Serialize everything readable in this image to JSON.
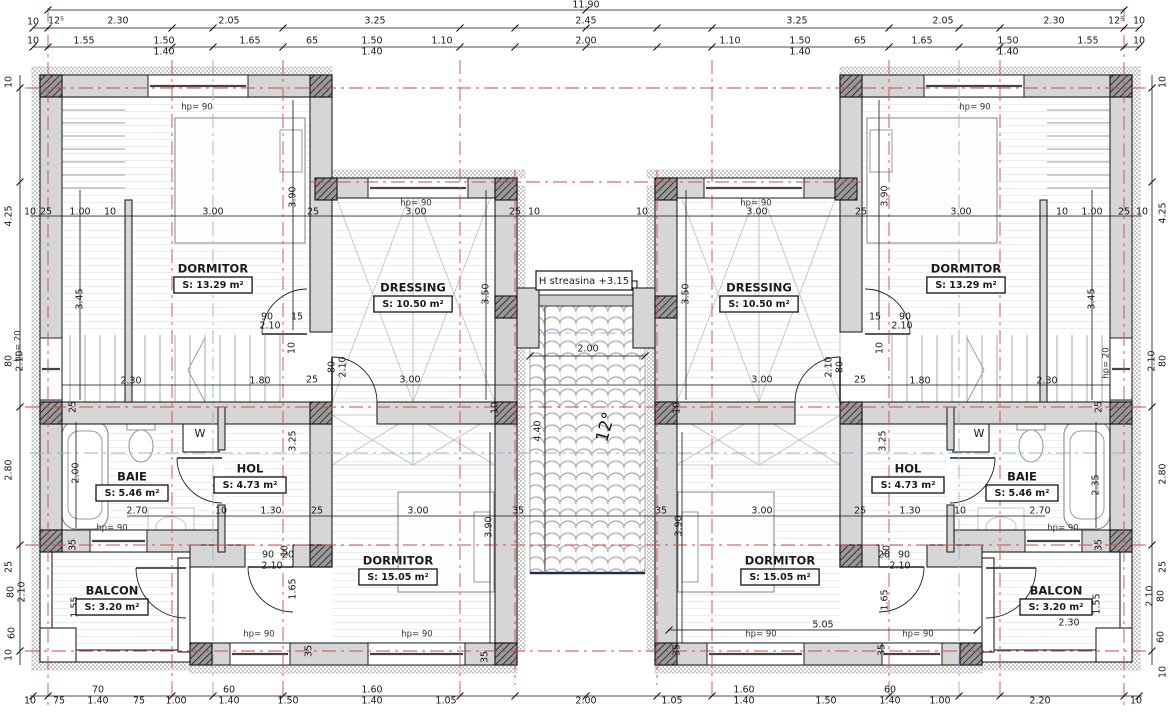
{
  "drawing": {
    "type": "floor-plan",
    "overall_width": "11.90",
    "eaves_note": "H streasina +3.15",
    "roof_slope": "12°",
    "colors": {
      "axis_red": "#cf4a4a",
      "axis_blue": "#8fb3dc",
      "wall_gray": "#d6d6d6",
      "pier_gray": "#9a9a9a",
      "line": "#222222",
      "fixture": "#9a9a9a",
      "tile": "#9a9a9a",
      "ridge_dark": "#223044"
    }
  },
  "rooms": [
    {
      "name": "DORMITOR",
      "area": "S: 13.29 m²",
      "x": 213,
      "y": 269
    },
    {
      "name": "DRESSING",
      "area": "S: 10.50 m²",
      "x": 413,
      "y": 288
    },
    {
      "name": "BAIE",
      "area": "S: 5.46 m²",
      "x": 132,
      "y": 477
    },
    {
      "name": "HOL",
      "area": "S: 4.73 m²",
      "x": 250,
      "y": 469
    },
    {
      "name": "DORMITOR",
      "area": "S: 15.05 m²",
      "x": 398,
      "y": 561
    },
    {
      "name": "BALCON",
      "area": "S: 3.20 m²",
      "x": 112,
      "y": 591
    },
    {
      "name": "DRESSING",
      "area": "S: 10.50 m²",
      "x": 759,
      "y": 288
    },
    {
      "name": "DORMITOR",
      "area": "S: 13.29 m²",
      "x": 966,
      "y": 269
    },
    {
      "name": "HOL",
      "area": "S: 4.73 m²",
      "x": 908,
      "y": 469
    },
    {
      "name": "BAIE",
      "area": "S: 5.46 m²",
      "x": 1022,
      "y": 477
    },
    {
      "name": "DORMITOR",
      "area": "S: 15.05 m²",
      "x": 780,
      "y": 561
    },
    {
      "name": "BALCON",
      "area": "S: 3.20 m²",
      "x": 1056,
      "y": 591
    }
  ],
  "dims": [
    [
      "11.90",
      586,
      5
    ],
    [
      "10",
      33,
      22
    ],
    [
      "12⁵",
      56,
      21
    ],
    [
      "2.30",
      118,
      21
    ],
    [
      "2.05",
      229,
      21
    ],
    [
      "3.25",
      375,
      21
    ],
    [
      "2.45",
      586,
      21
    ],
    [
      "3.25",
      797,
      21
    ],
    [
      "2.05",
      943,
      21
    ],
    [
      "2.30",
      1054,
      21
    ],
    [
      "12⁵",
      1116,
      21
    ],
    [
      "10",
      1139,
      21
    ],
    [
      "10",
      33,
      41
    ],
    [
      "1.55",
      84,
      41
    ],
    [
      "1.50",
      164,
      41
    ],
    [
      "1.65",
      250,
      41
    ],
    [
      "65",
      312,
      41
    ],
    [
      "1.50",
      372,
      41
    ],
    [
      "1.10",
      442,
      41
    ],
    [
      "2.00",
      586,
      41
    ],
    [
      "1.10",
      730,
      41
    ],
    [
      "1.50",
      800,
      41
    ],
    [
      "65",
      860,
      41
    ],
    [
      "1.65",
      922,
      41
    ],
    [
      "1.50",
      1008,
      41
    ],
    [
      "1.55",
      1088,
      41
    ],
    [
      "10",
      1139,
      41
    ],
    [
      "1.40",
      164,
      52
    ],
    [
      "1.40",
      372,
      52
    ],
    [
      "1.40",
      800,
      52
    ],
    [
      "1.40",
      1008,
      52
    ],
    [
      "10",
      30,
      212
    ],
    [
      "25",
      46,
      212
    ],
    [
      "1.00",
      80,
      212
    ],
    [
      "10",
      110,
      212
    ],
    [
      "3.00",
      213,
      212
    ],
    [
      "25",
      313,
      212
    ],
    [
      "3.00",
      416,
      212
    ],
    [
      "25",
      515,
      212
    ],
    [
      "10",
      534,
      212
    ],
    [
      "10",
      642,
      212
    ],
    [
      "3.00",
      757,
      212
    ],
    [
      "25",
      861,
      212
    ],
    [
      "3.00",
      961,
      212
    ],
    [
      "10",
      1062,
      212
    ],
    [
      "1.00",
      1092,
      212
    ],
    [
      "25",
      1124,
      212
    ],
    [
      "10",
      1142,
      212
    ],
    [
      "2.30",
      131,
      381
    ],
    [
      "1.80",
      260,
      381
    ],
    [
      "25",
      312,
      380
    ],
    [
      "3.00",
      410,
      380
    ],
    [
      "3.00",
      762,
      380
    ],
    [
      "25",
      860,
      380
    ],
    [
      "1.80",
      920,
      381
    ],
    [
      "2.30",
      1047,
      381
    ],
    [
      "2.70",
      137,
      511
    ],
    [
      "10",
      221,
      511
    ],
    [
      "1.30",
      271,
      511
    ],
    [
      "25",
      317,
      511
    ],
    [
      "3.00",
      418,
      511
    ],
    [
      "35",
      518,
      511
    ],
    [
      "35",
      661,
      511
    ],
    [
      "3.00",
      762,
      511
    ],
    [
      "25",
      860,
      511
    ],
    [
      "1.30",
      910,
      511
    ],
    [
      "10",
      960,
      511
    ],
    [
      "2.70",
      1040,
      511
    ],
    [
      "70",
      98,
      690
    ],
    [
      "60",
      229,
      690
    ],
    [
      "1.60",
      372,
      690
    ],
    [
      "1.60",
      744,
      690
    ],
    [
      "60",
      890,
      690
    ],
    [
      "10",
      30,
      701
    ],
    [
      "75",
      59,
      701
    ],
    [
      "1.40",
      98,
      701
    ],
    [
      "75",
      139,
      701
    ],
    [
      "1.00",
      176,
      701
    ],
    [
      "1.40",
      229,
      701
    ],
    [
      "1.50",
      288,
      701
    ],
    [
      "1.40",
      372,
      701
    ],
    [
      "1.05",
      446,
      701
    ],
    [
      "2.00",
      586,
      701
    ],
    [
      "1.05",
      672,
      701
    ],
    [
      "1.40",
      744,
      701
    ],
    [
      "1.50",
      826,
      701
    ],
    [
      "1.40",
      890,
      701
    ],
    [
      "1.00",
      940,
      701
    ],
    [
      "2.20",
      1040,
      701
    ],
    [
      "10",
      1136,
      701
    ],
    [
      "10",
      9,
      82,
      -90
    ],
    [
      "4.25",
      9,
      216,
      -90
    ],
    [
      "80",
      9,
      361,
      -90
    ],
    [
      "2.10",
      20,
      361,
      -90
    ],
    [
      "2.80",
      9,
      470,
      -90
    ],
    [
      "25",
      9,
      567,
      -90
    ],
    [
      "80",
      11,
      592,
      -90
    ],
    [
      "2.10",
      22,
      592,
      -90
    ],
    [
      "60",
      12,
      633,
      -90
    ],
    [
      "10",
      9,
      655,
      -90
    ],
    [
      "10",
      1163,
      82,
      -90
    ],
    [
      "4.25",
      1163,
      213,
      -90
    ],
    [
      "80",
      1163,
      361,
      -90
    ],
    [
      "2.10",
      1152,
      361,
      -90
    ],
    [
      "2.80",
      1163,
      474,
      -90
    ],
    [
      "25",
      1163,
      567,
      -90
    ],
    [
      "80",
      1161,
      596,
      -90
    ],
    [
      "2.10",
      1150,
      596,
      -90
    ],
    [
      "60",
      1161,
      637,
      -90
    ],
    [
      "10",
      1163,
      672,
      -90
    ],
    [
      "3.90",
      293,
      197,
      -90
    ],
    [
      "3.90",
      885,
      196,
      -90
    ],
    [
      "3.45",
      80,
      299,
      -90
    ],
    [
      "3.45",
      1092,
      299,
      -90
    ],
    [
      "3.50",
      486,
      294,
      -90
    ],
    [
      "3.50",
      686,
      294,
      -90
    ],
    [
      "25",
      73,
      407,
      -90
    ],
    [
      "25",
      1099,
      407,
      -90
    ],
    [
      "3.25",
      293,
      441,
      -90
    ],
    [
      "3.25",
      883,
      441,
      -90
    ],
    [
      "2.00",
      76,
      473,
      -90
    ],
    [
      "2.35",
      1096,
      485,
      -90
    ],
    [
      "35",
      73,
      545,
      -90
    ],
    [
      "35",
      1099,
      545,
      -90
    ],
    [
      "3.90",
      489,
      527,
      -90
    ],
    [
      "3.90",
      679,
      526,
      -90
    ],
    [
      "1.55",
      75,
      607,
      -90
    ],
    [
      "1.55",
      1097,
      604,
      -90
    ],
    [
      "1.65",
      293,
      589,
      -90
    ],
    [
      "1.65",
      885,
      600,
      -90
    ],
    [
      "35",
      309,
      651,
      -90
    ],
    [
      "35",
      485,
      657,
      -90
    ],
    [
      "35",
      677,
      650,
      -90
    ],
    [
      "35",
      882,
      650,
      -90
    ],
    [
      "10",
      285,
      551,
      -90
    ],
    [
      "10",
      887,
      551,
      -90
    ],
    [
      "10",
      292,
      348,
      -90
    ],
    [
      "10",
      880,
      348,
      -90
    ],
    [
      "80",
      332,
      367,
      -90
    ],
    [
      "2.10",
      343,
      367,
      -90
    ],
    [
      "80",
      840,
      367,
      -90
    ],
    [
      "2.10",
      829,
      367,
      -90
    ],
    [
      "10",
      495,
      408,
      -90
    ],
    [
      "10",
      677,
      408,
      -90
    ],
    [
      "90",
      267,
      317
    ],
    [
      "15",
      297,
      317
    ],
    [
      "2.10",
      270,
      326
    ],
    [
      "15",
      875,
      317
    ],
    [
      "90",
      905,
      317
    ],
    [
      "2.10",
      902,
      326
    ],
    [
      "90",
      268,
      555
    ],
    [
      "20",
      288,
      555
    ],
    [
      "2.10",
      272,
      566
    ],
    [
      "20",
      884,
      555
    ],
    [
      "90",
      904,
      555
    ],
    [
      "2.10",
      900,
      566
    ],
    [
      "2.00",
      588,
      349
    ],
    [
      "4.40",
      538,
      431,
      -90
    ],
    [
      "5.05",
      823,
      625
    ],
    [
      "2.30",
      1069,
      623
    ],
    [
      "W",
      200,
      434,
      0,
      11
    ],
    [
      "W",
      979,
      434,
      0,
      11
    ]
  ],
  "tags": [
    [
      "hp= 90",
      197,
      107
    ],
    [
      "hp= 90",
      975,
      107
    ],
    [
      "hp= 90",
      416,
      203
    ],
    [
      "hp= 90",
      756,
      203
    ],
    [
      "hp= 90",
      112,
      528
    ],
    [
      "hp= 90",
      1063,
      528
    ],
    [
      "hp= 90",
      417,
      634
    ],
    [
      "hp= 90",
      761,
      634
    ],
    [
      "hp= 90",
      259,
      634
    ],
    [
      "hp= 90",
      918,
      634
    ],
    [
      "hp= 20",
      18,
      346,
      -90
    ],
    [
      "hp= 20",
      1106,
      363,
      -90
    ]
  ]
}
